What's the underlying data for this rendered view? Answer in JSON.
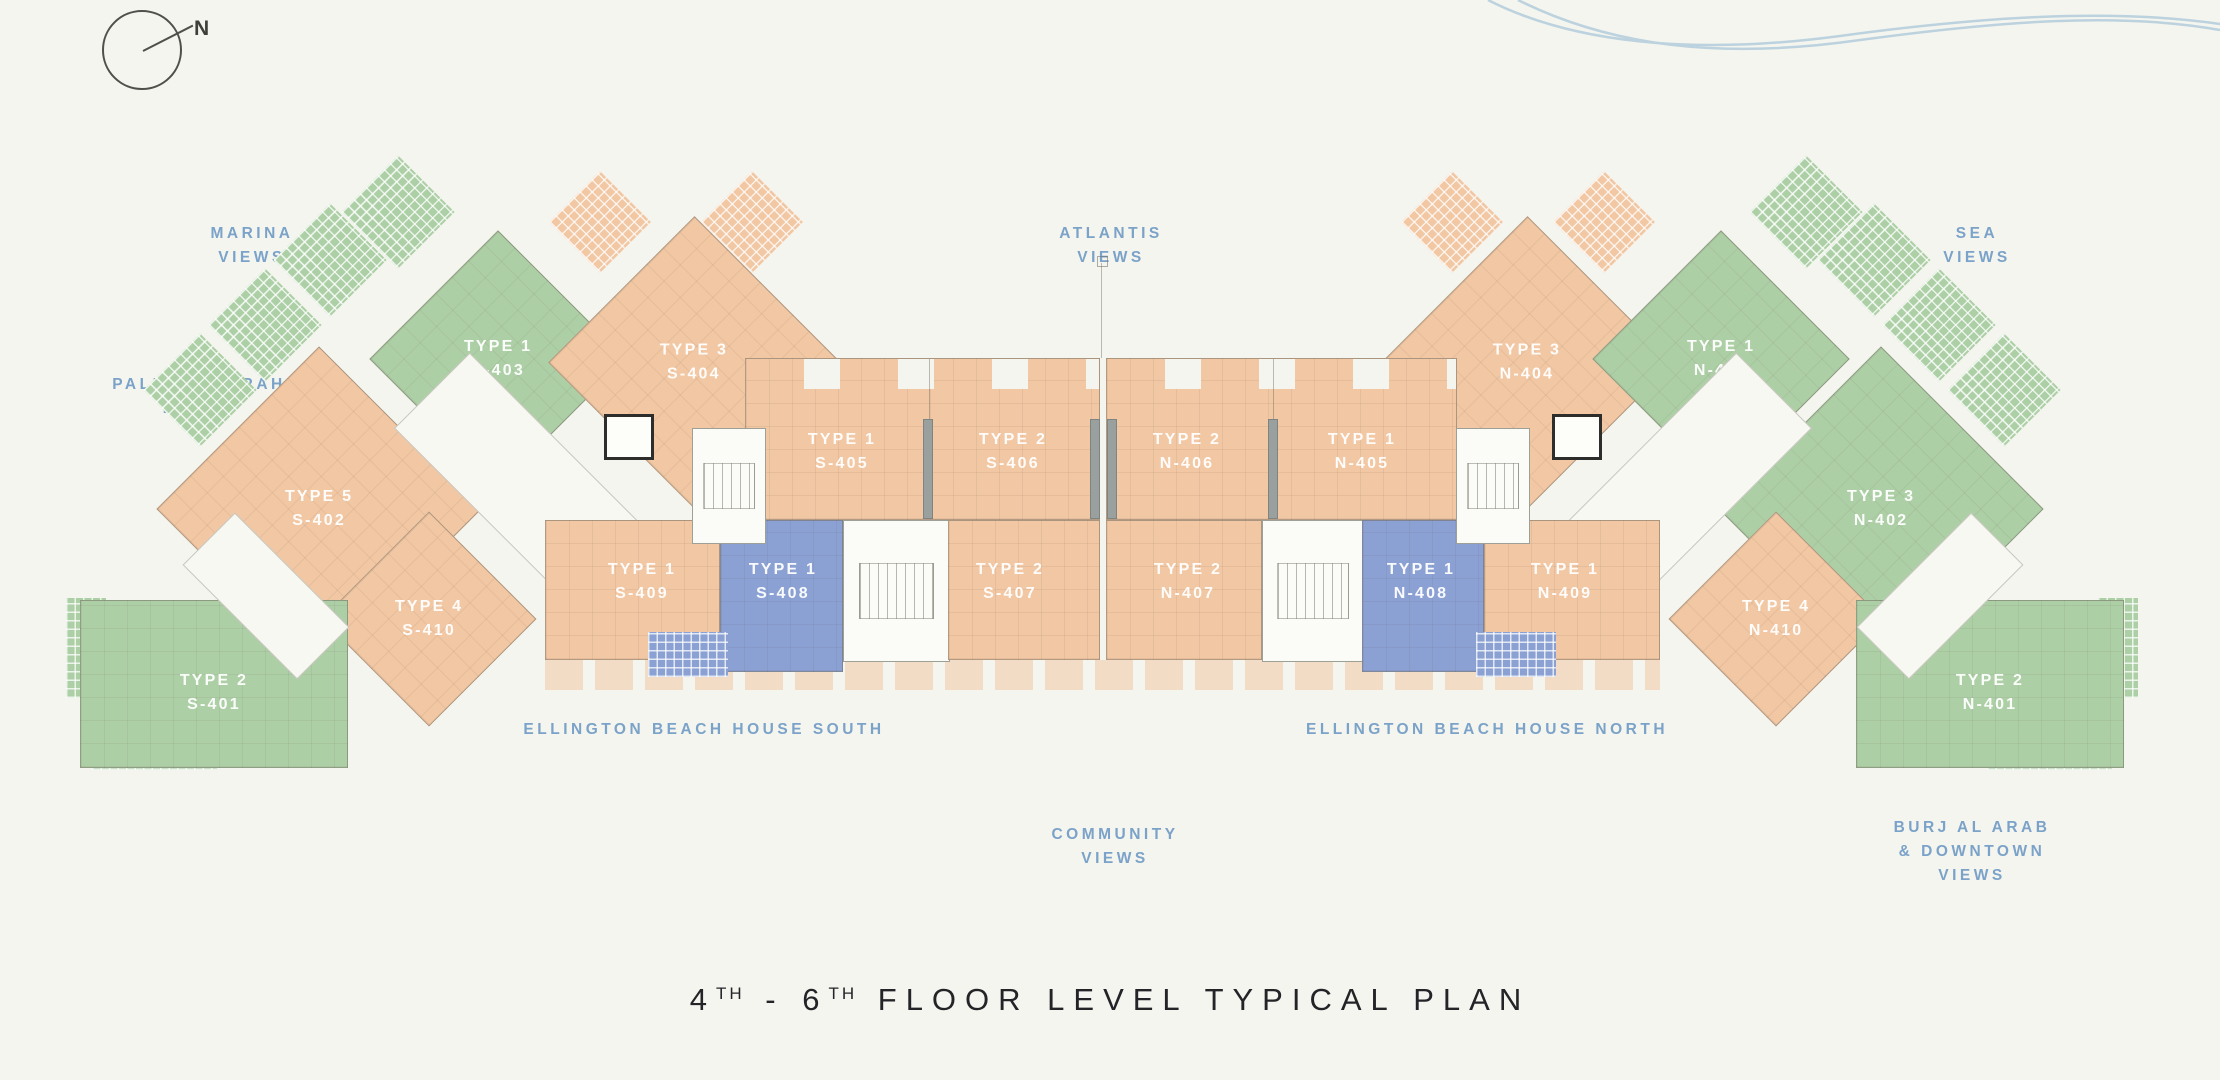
{
  "compass": {
    "label": "N"
  },
  "view_labels": {
    "marina": "MARINA\nVIEWS",
    "atlantis": "ATLANTIS\nVIEWS",
    "sea": "SEA\nVIEWS",
    "palm_jumeirah": "PALM JUMEIRAH\nBEACH",
    "community": "COMMUNITY\nVIEWS",
    "burj": "BURJ AL ARAB\n& DOWNTOWN\nVIEWS"
  },
  "buildings": {
    "south": "ELLINGTON BEACH HOUSE SOUTH",
    "north": "ELLINGTON BEACH HOUSE NORTH"
  },
  "units": {
    "s401": {
      "type": "TYPE 2",
      "no": "S-401",
      "color": "green"
    },
    "s402": {
      "type": "TYPE 5",
      "no": "S-402",
      "color": "peach"
    },
    "s403": {
      "type": "TYPE 1",
      "no": "S-403",
      "color": "green"
    },
    "s404": {
      "type": "TYPE 3",
      "no": "S-404",
      "color": "peach"
    },
    "s405": {
      "type": "TYPE 1",
      "no": "S-405",
      "color": "peach"
    },
    "s406": {
      "type": "TYPE 2",
      "no": "S-406",
      "color": "peach"
    },
    "s407": {
      "type": "TYPE 2",
      "no": "S-407",
      "color": "peach"
    },
    "s408": {
      "type": "TYPE 1",
      "no": "S-408",
      "color": "blue"
    },
    "s409": {
      "type": "TYPE 1",
      "no": "S-409",
      "color": "peach"
    },
    "s410": {
      "type": "TYPE 4",
      "no": "S-410",
      "color": "peach"
    },
    "n401": {
      "type": "TYPE 2",
      "no": "N-401",
      "color": "green"
    },
    "n402": {
      "type": "TYPE 3",
      "no": "N-402",
      "color": "green"
    },
    "n403": {
      "type": "TYPE 1",
      "no": "N-403",
      "color": "green"
    },
    "n404": {
      "type": "TYPE 3",
      "no": "N-404",
      "color": "peach"
    },
    "n405": {
      "type": "TYPE 1",
      "no": "N-405",
      "color": "peach"
    },
    "n406": {
      "type": "TYPE 2",
      "no": "N-406",
      "color": "peach"
    },
    "n407": {
      "type": "TYPE 2",
      "no": "N-407",
      "color": "peach"
    },
    "n408": {
      "type": "TYPE 1",
      "no": "N-408",
      "color": "blue"
    },
    "n409": {
      "type": "TYPE 1",
      "no": "N-409",
      "color": "peach"
    },
    "n410": {
      "type": "TYPE 4",
      "no": "N-410",
      "color": "peach"
    }
  },
  "title": {
    "p1": "4",
    "s1": "TH",
    "p2": " - 6",
    "s2": "TH",
    "p3": " FLOOR LEVEL TYPICAL PLAN"
  },
  "colors": {
    "background": "#f4f5ef",
    "unit_green": "#adcfa6",
    "unit_peach": "#f2c7a3",
    "unit_blue": "#8ba0d3",
    "label_blue": "#7ba2c8",
    "title_text": "#242428",
    "wave_blue": "#bcd2de"
  }
}
